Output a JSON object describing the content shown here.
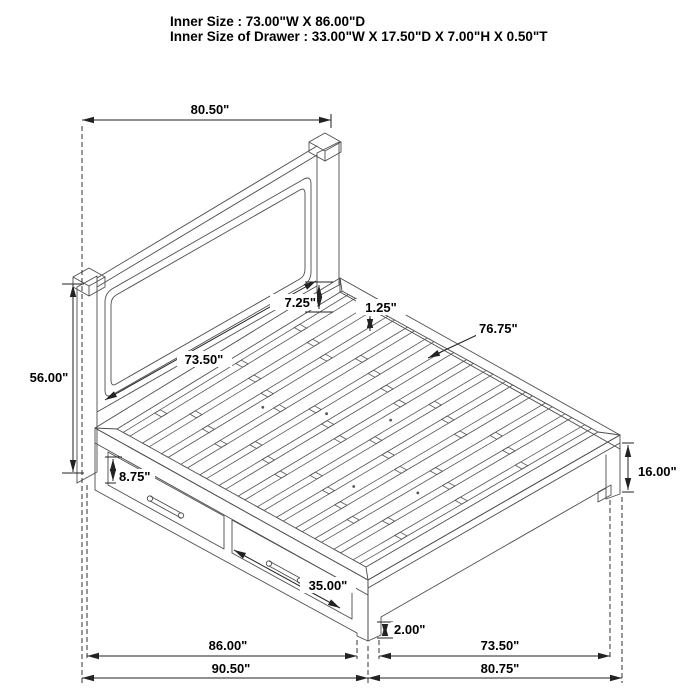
{
  "header": {
    "line1": "Inner Size : 73.00\"W X 86.00\"D",
    "line2": "Inner Size of Drawer : 33.00\"W X 17.50\"D X 7.00\"H X 0.50\"T"
  },
  "dims": {
    "headboard_width": "80.50\"",
    "headboard_height": "56.00\"",
    "headboard_panel_width": "73.50\"",
    "headboard_to_deck_gap": "7.25\"",
    "slat_thickness": "1.25\"",
    "slat_length": "76.75\"",
    "drawer_face_height": "8.75\"",
    "drawer_face_width": "35.00\"",
    "footboard_height": "16.00\"",
    "floor_clearance": "2.00\"",
    "side_length_inner": "86.00\"",
    "side_length_overall": "90.50\"",
    "foot_width_inner": "73.50\"",
    "foot_width_overall": "80.75\""
  },
  "colors": {
    "background": "#ffffff",
    "drawing_line": "#4d4d4d",
    "dimension_line": "#222222",
    "text": "#000000"
  },
  "diagram": {
    "type": "isometric-line-drawing",
    "subject": "storage platform bed with headboard, slats and two side drawers"
  }
}
